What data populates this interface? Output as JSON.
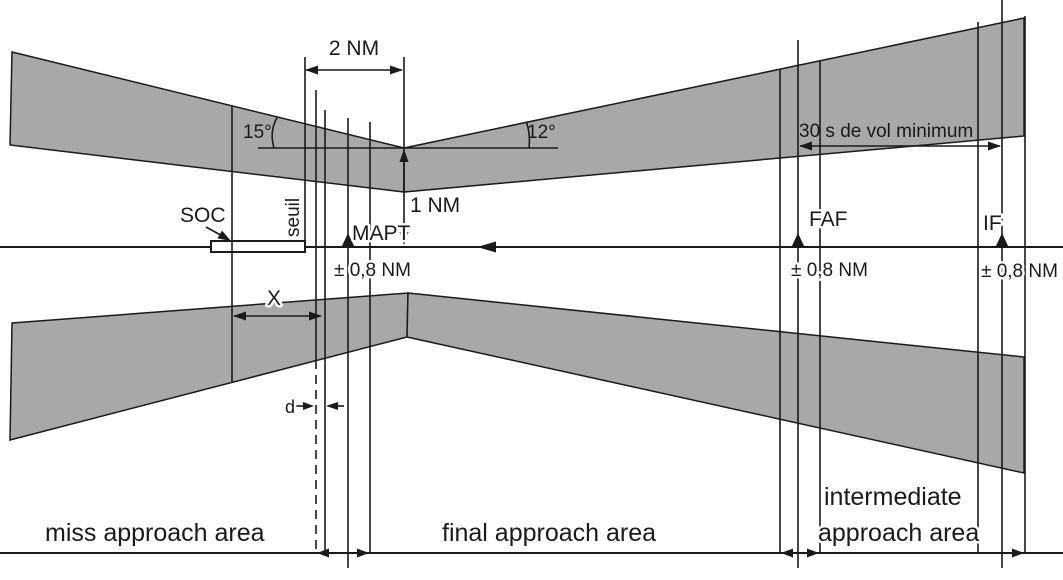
{
  "colors": {
    "area_fill": "#a8a8a8",
    "line": "#1a1a1a",
    "background": "#ffffff"
  },
  "labels": {
    "dim_2nm": "2 NM",
    "dim_1nm": "1 NM",
    "dim_x": "X",
    "dim_d": "d",
    "dim_30s": "30 s de vol minimum",
    "angle_left": "15°",
    "angle_right": "12°",
    "soc": "SOC",
    "seuil": "seuil",
    "mapt": "MAPT",
    "mapt_tolerance": "± 0,8 NM",
    "faf": "FAF",
    "faf_tolerance": "± 0,8 NM",
    "if": "IF",
    "if_tolerance": "± 0,8 NM",
    "area_miss": "miss approach area",
    "area_final": "final approach area",
    "area_intermediate_line1": "intermediate",
    "area_intermediate_line2": "approach area"
  }
}
